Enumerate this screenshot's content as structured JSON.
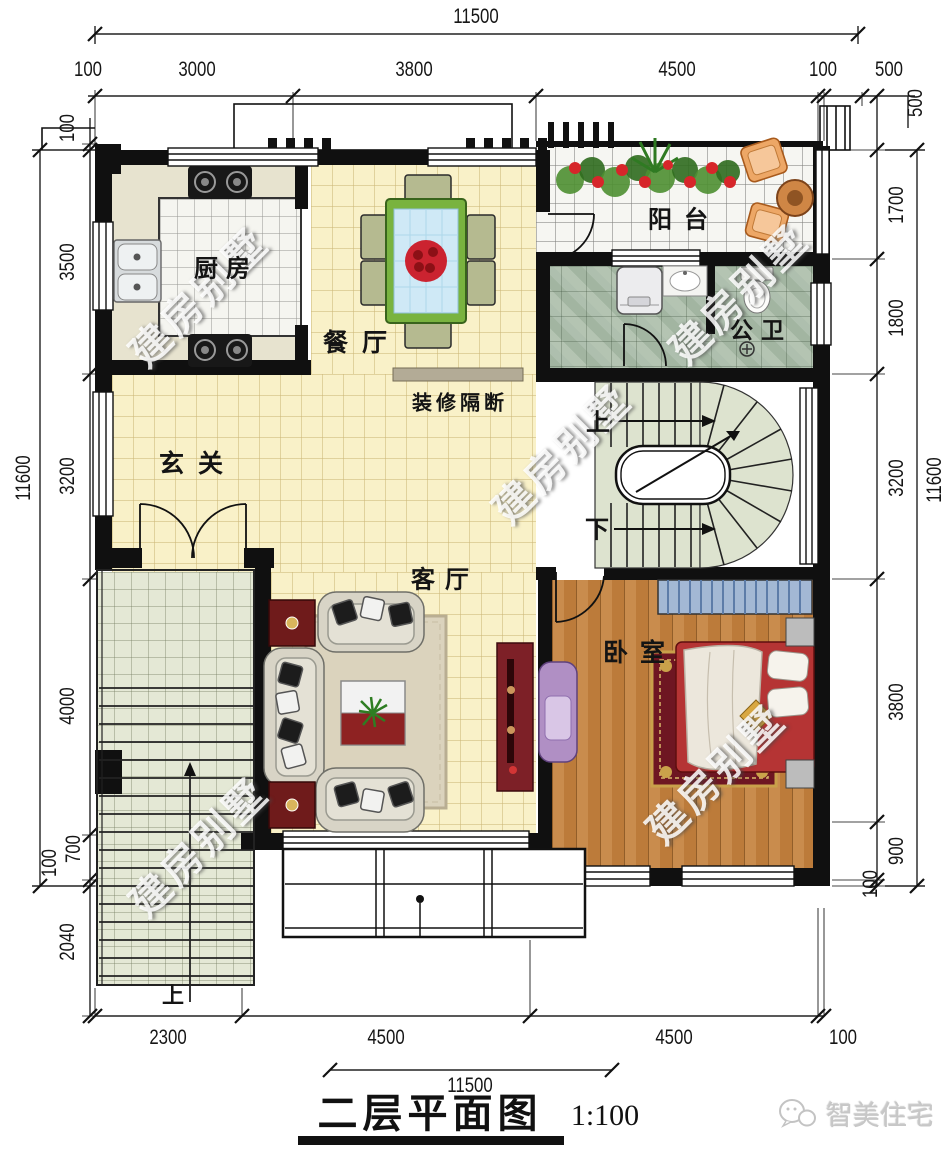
{
  "watermark": {
    "text": "建房别墅"
  },
  "brand": {
    "name": "智美住宅",
    "icon": "chat-bubbles-icon"
  },
  "title": {
    "text": "二层平面图",
    "scale": "1:100"
  },
  "rooms": {
    "kitchen": "厨房",
    "dining": "餐厅",
    "partition": "装修隔断",
    "hall": "玄关",
    "balcony": "阳台",
    "bathroom": "公卫",
    "living": "客厅",
    "bedroom": "卧室",
    "stair_up": "上",
    "stair_down": "下",
    "terrace_up": "上"
  },
  "dimensions": {
    "top": {
      "total": "11500",
      "segments": [
        "100",
        "3000",
        "3800",
        "4500",
        "100"
      ],
      "right_offset_h": "500",
      "right_offset_v": "500"
    },
    "left": {
      "total": "11600",
      "segments": [
        "100",
        "3500",
        "3200",
        "4000",
        "700",
        "100",
        "2040"
      ]
    },
    "right": {
      "total": "11600",
      "segments": [
        "1700",
        "1800",
        "3200",
        "3800",
        "900",
        "100"
      ]
    },
    "bottom": {
      "total": "11500",
      "segments": [
        "2300",
        "4500",
        "4500",
        "100"
      ]
    }
  },
  "palette": {
    "wall_black": "#101010",
    "floor_yellow": "#f9f1c8",
    "kitchen_tile": "#f5f5f0",
    "marble_green": "#aebfae",
    "wood_brown": "#c98c4d",
    "terrace_green": "#e4e8d5",
    "table_green": "#79b33f",
    "glass_blue": "#cfe9f6",
    "flower_red": "#cb2330",
    "cabinet_red": "#7d2027",
    "sofa_beige": "#d8d4c6",
    "bed_red": "#b53434",
    "chair_orange": "#eda766",
    "chair_purple": "#b08fc4"
  }
}
